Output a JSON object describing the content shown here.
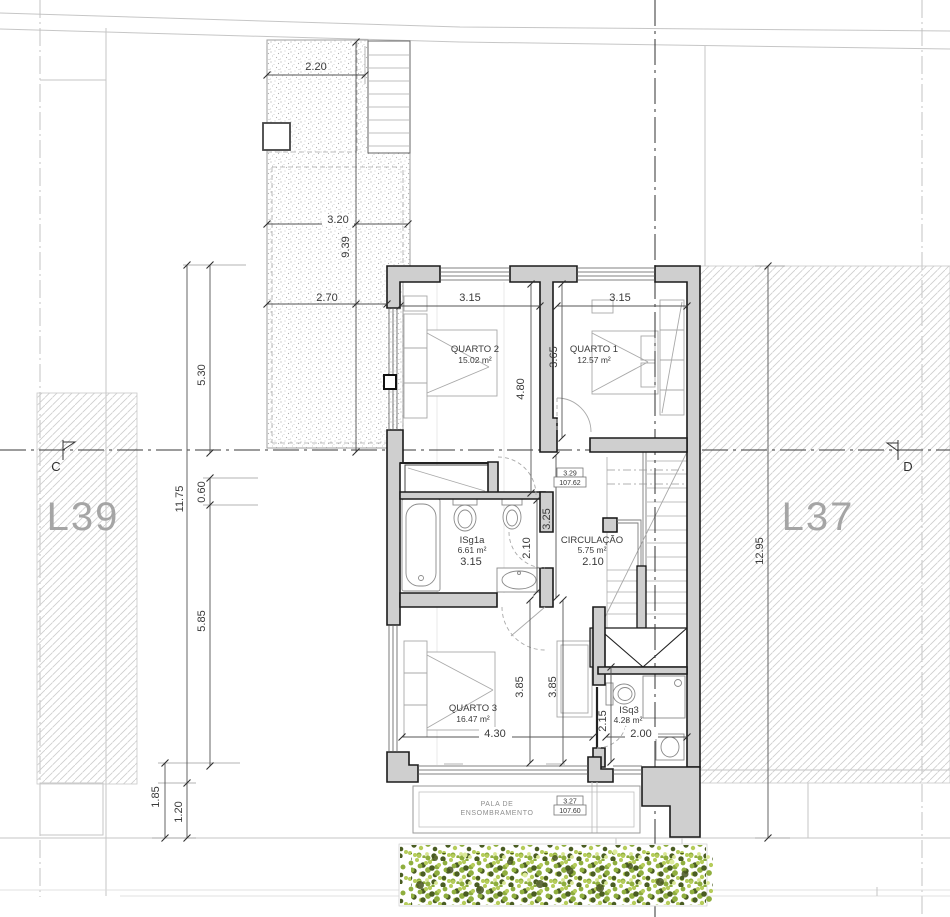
{
  "site": {
    "lot_left": "L39",
    "lot_right": "L37",
    "section_left": "C",
    "section_right": "D"
  },
  "rooms": {
    "quarto2": {
      "name": "QUARTO 2",
      "area": "15.02 m²"
    },
    "quarto1": {
      "name": "QUARTO 1",
      "area": "12.57 m²"
    },
    "isg1a": {
      "name": "ISg1a",
      "area": "6.61 m²"
    },
    "circulacao": {
      "name": "CIRCULAÇÃO",
      "area": "5.75 m²"
    },
    "quarto3": {
      "name": "QUARTO 3",
      "area": "16.47 m²"
    },
    "isq3": {
      "name": "ISq3",
      "area": "4.28 m²"
    }
  },
  "levels": {
    "hall": {
      "value": "3.29",
      "elevation": "107.62"
    },
    "pala": {
      "value": "3.27",
      "elevation": "107.60"
    }
  },
  "pala": {
    "label_line1": "PALA DE",
    "label_line2": "ENSOMBRAMENTO"
  },
  "dims": {
    "terrace_top": "2.20",
    "terrace_mid": "3.20",
    "terrace_height": "9.39",
    "terrace_low": "2.70",
    "q2_width": "3.15",
    "q1_width": "3.15",
    "q2_depth": "4.80",
    "q1_depth": "3.65",
    "hall_depth": "3.25",
    "isg1a_depth": "2.10",
    "isg1a_width": "3.15",
    "circ_width": "2.10",
    "q3_depth_left": "3.85",
    "q3_depth_right": "3.85",
    "q3_width": "4.30",
    "isq3_depth": "2.15",
    "isq3_width": "2.00",
    "left_upper": "5.30",
    "left_total": "11.75",
    "left_mid": "0.60",
    "left_lower": "5.85",
    "bottom_left_outer": "1.85",
    "bottom_left_inner": "1.20",
    "right_total": "12.95"
  },
  "colors": {
    "wall_fill": "#cfcfcf",
    "wall_line": "#1b1b1b",
    "hatch": "#cdcdcd",
    "lot_label": "#a5a5a5",
    "foliage_light": "#b5cc5a",
    "foliage_mid": "#8fae3e",
    "foliage_dark": "#4a5d22"
  }
}
